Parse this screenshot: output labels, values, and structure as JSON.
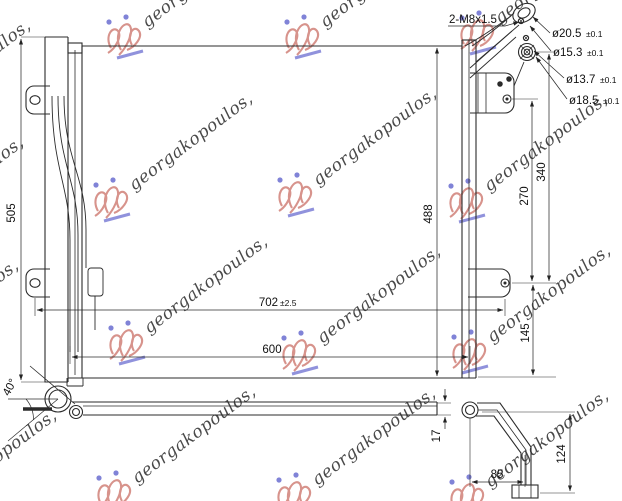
{
  "watermark": {
    "text": "georgakopoulos,",
    "text_color": "#7b74d8",
    "logo_color": "#c96a5f",
    "accent_color": "#4f52c8"
  },
  "callouts": {
    "thread": "2-M8x1.5",
    "dia1": "ø20.5",
    "dia1_tol": "±0.1",
    "dia2": "ø15.3",
    "dia2_tol": "±0.1",
    "dia3": "ø13.7",
    "dia3_tol": "±0.1",
    "dia4": "ø18.5",
    "dia4_tol": "±0.1"
  },
  "dimensions": {
    "left_height": "505",
    "core_height": "488",
    "overall_width": "702",
    "overall_width_tol": "±2.5",
    "core_width": "600",
    "fitting_drop": "340",
    "bracket_span": "270",
    "bracket_to_bottom": "145",
    "pipe_angle": "40°",
    "thickness": "17",
    "pipe_offset": "85",
    "pipe_drop": "124"
  }
}
